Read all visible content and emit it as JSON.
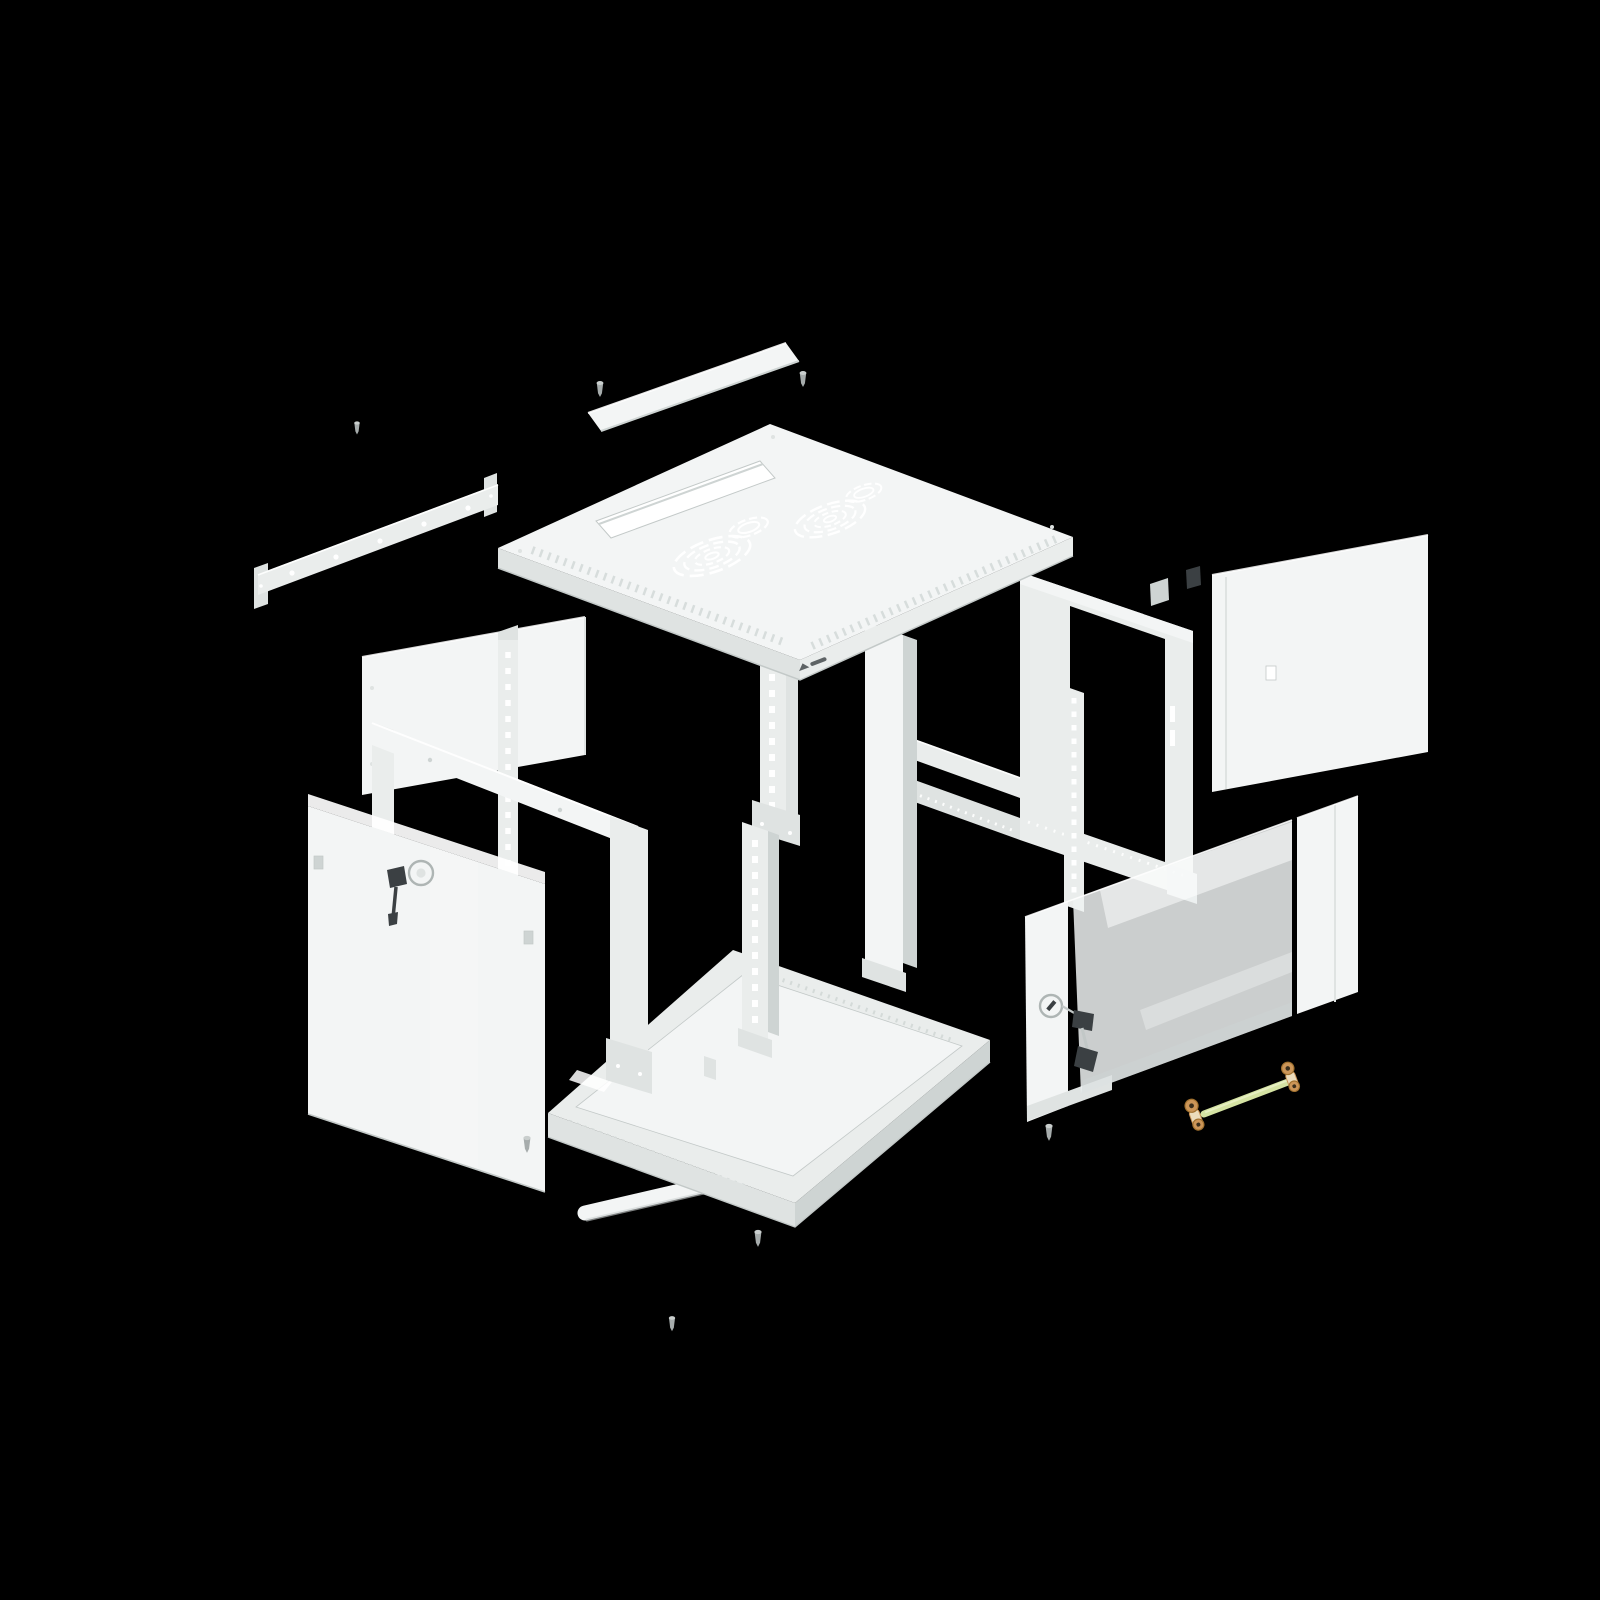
{
  "scene": {
    "type": "product-exploded-view",
    "description": "Exploded 3D view of a light-gray wall-mount network rack cabinet on a black background: top panel with fan vents and cable slot, wall rail, side panels, frame beams, punched 19-inch mounting rails, bottom tray, solid front door with lock and key, glass door with lock and keys, loose screws and a yellow-green grounding cable with copper lugs.",
    "background": "#000000",
    "visible_text": [],
    "logo": {
      "visible": true,
      "legible": false
    }
  },
  "colors": {
    "background": "#000000",
    "panel": "#eaedec",
    "panel_bright": "#f3f5f5",
    "panel_mid": "#dfe3e2",
    "panel_shade": "#ced4d3",
    "edge": "#c3c9c8",
    "white": "#ffffff",
    "hardware_dark": "#3b4043",
    "metal_pin": "#a6acac",
    "metal_pin_hi": "#c9cecd",
    "key_metal": "#c2c8c7",
    "glass": "#eef2f2",
    "ground_wire": "#d5e3a3",
    "ground_wire_hi": "#e7efc2",
    "lug_copper": "#cb9558",
    "lug_copper_dark": "#a1712f",
    "lug_sleeve": "#ecdcbc"
  },
  "parts": [
    {
      "id": "wall-mount-rail"
    },
    {
      "id": "top-cable-cover-strip"
    },
    {
      "id": "top-panel"
    },
    {
      "id": "fan-vent-left"
    },
    {
      "id": "fan-vent-right"
    },
    {
      "id": "top-cable-slot"
    },
    {
      "id": "brand-logo-mark"
    },
    {
      "id": "right-side-panel"
    },
    {
      "id": "rear-frame-ring"
    },
    {
      "id": "left-side-panel"
    },
    {
      "id": "mounting-rail-left"
    },
    {
      "id": "mounting-rail-front-upper"
    },
    {
      "id": "mounting-rail-front-lower"
    },
    {
      "id": "mounting-rail-right"
    },
    {
      "id": "frame-beam-assembly"
    },
    {
      "id": "rear-corner-post"
    },
    {
      "id": "rear-beam-upper"
    },
    {
      "id": "rear-beam-lower"
    },
    {
      "id": "bottom-tray"
    },
    {
      "id": "bottom-cable-cover-strip"
    },
    {
      "id": "solid-front-door"
    },
    {
      "id": "door-lock-left"
    },
    {
      "id": "door-key-left"
    },
    {
      "id": "glass-front-door"
    },
    {
      "id": "door-lock-right"
    },
    {
      "id": "door-keys-right"
    },
    {
      "id": "grounding-cable"
    },
    {
      "id": "screws"
    }
  ]
}
